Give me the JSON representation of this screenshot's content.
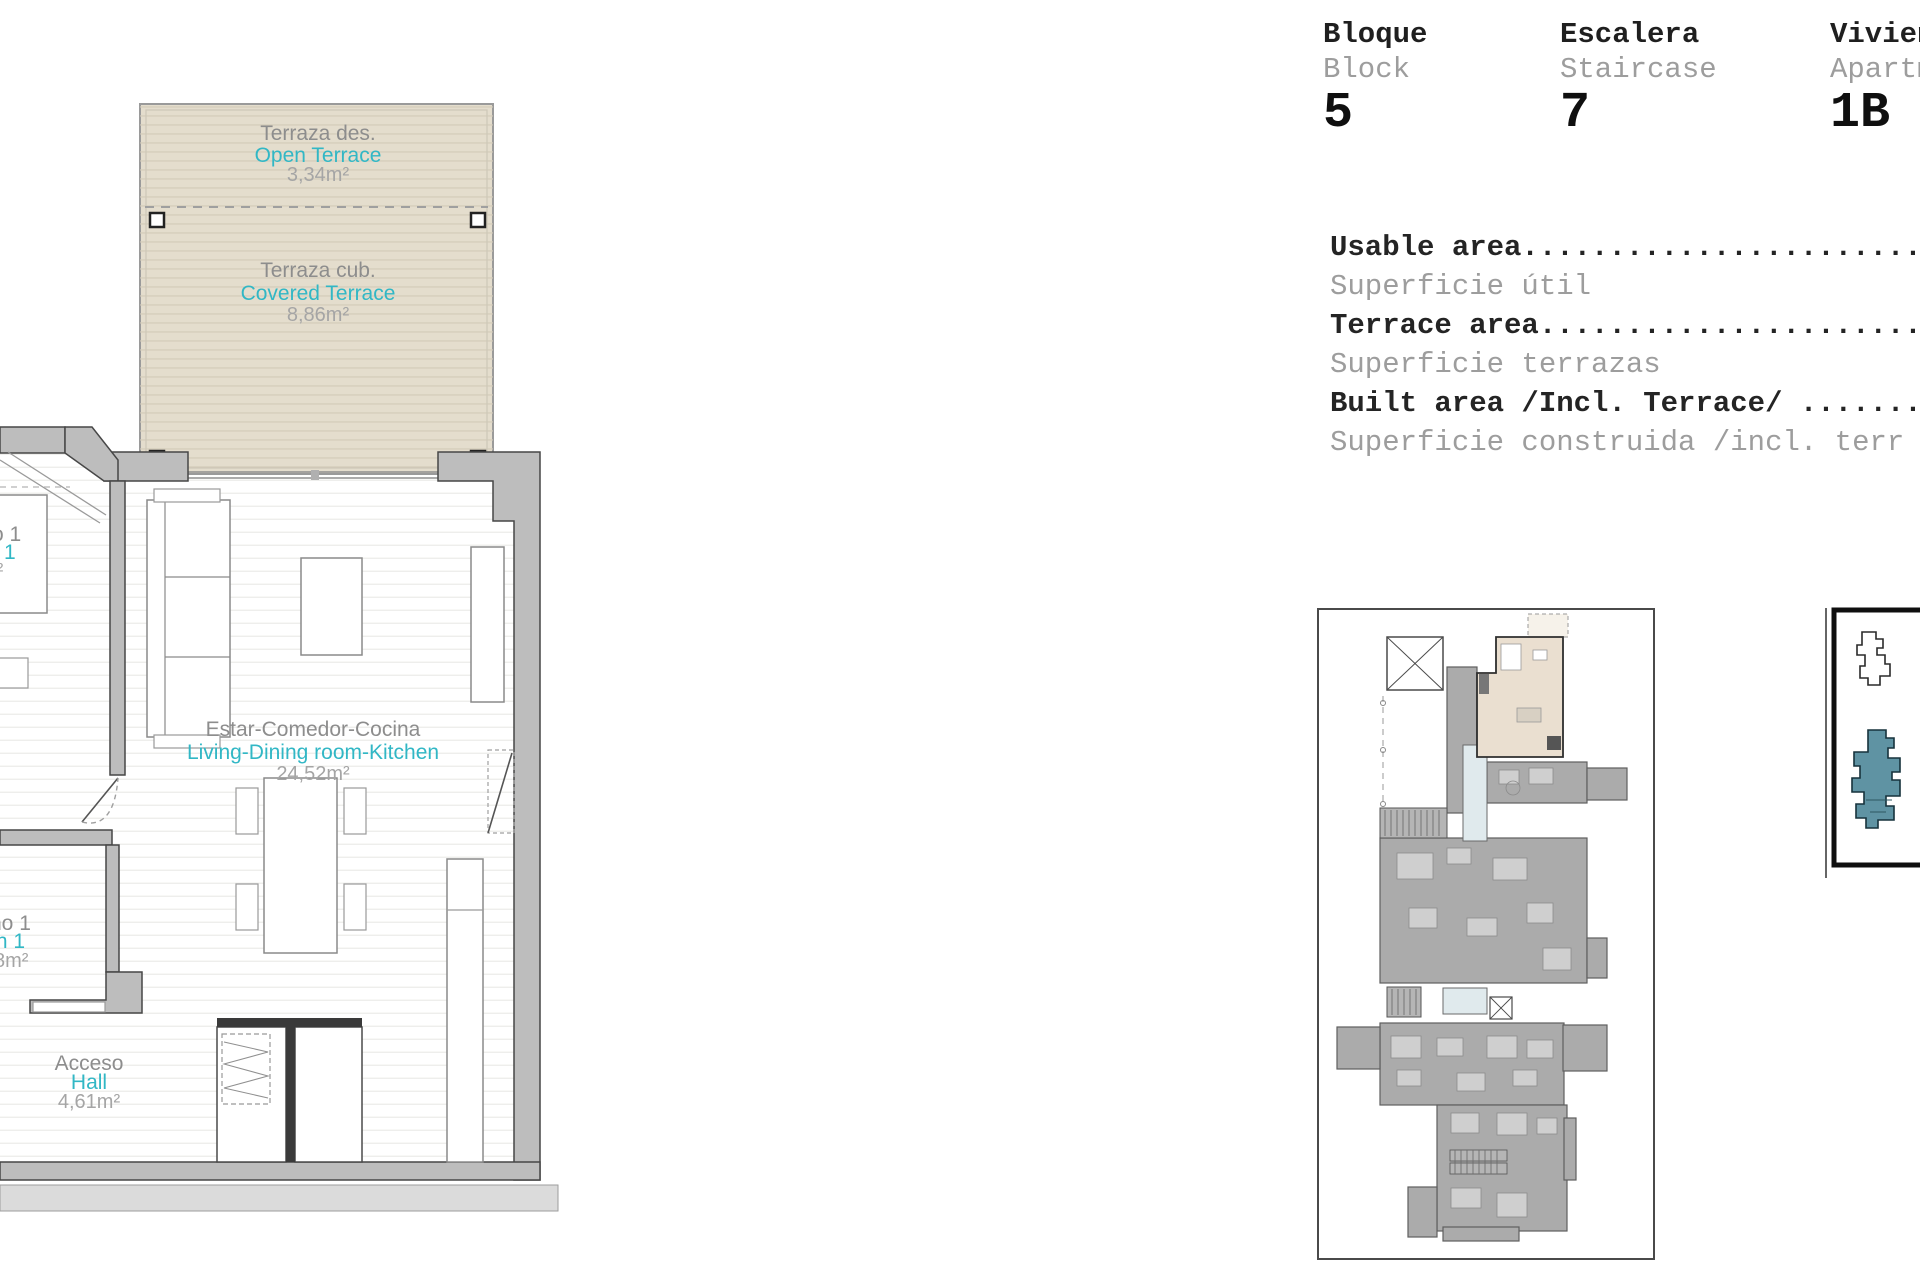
{
  "header": {
    "columns": [
      {
        "label_es": "Bloque",
        "label_en": "Block",
        "value": "5"
      },
      {
        "label_es": "Escalera",
        "label_en": "Staircase",
        "value": "7"
      },
      {
        "label_es": "Vivienda",
        "label_en": "Apartment",
        "value": "1B"
      }
    ]
  },
  "area_table": {
    "rows": [
      {
        "en": "Usable area..........................",
        "es": "Superficie útil"
      },
      {
        "en": "Terrace area.........................",
        "es": "Superficie terrazas"
      },
      {
        "en": "Built area /Incl. Terrace/ ..........",
        "es": "Superficie construida /incl. terr"
      }
    ]
  },
  "floor_plan": {
    "open_terrace": {
      "es": "Terraza des.",
      "en": "Open Terrace",
      "area": "3,34m²"
    },
    "covered_terrace": {
      "es": "Terraza cub.",
      "en": "Covered Terrace",
      "area": "8,86m²"
    },
    "living": {
      "es": "Estar-Comedor-Cocina",
      "en": "Living-Dining room-Kitchen",
      "area": "24,52m²"
    },
    "bedroom_fragment": {
      "es": "o 1",
      "en": "1",
      "area": "m²"
    },
    "bath_fragment": {
      "es": "ño 1",
      "en": "th 1",
      "area": "8m²"
    },
    "hall": {
      "es": "Acceso",
      "en": "Hall",
      "area": "4,61m²"
    }
  },
  "colors": {
    "accent_teal": "#31b7c5",
    "label_gray": "#8d8d8d",
    "area_gray": "#a5a5a5",
    "terrace_fill": "#e4ddcd",
    "wall_fill": "#bdbdbd",
    "unit_highlight": "#eadfd0",
    "building_highlight": "#5f93a3"
  }
}
